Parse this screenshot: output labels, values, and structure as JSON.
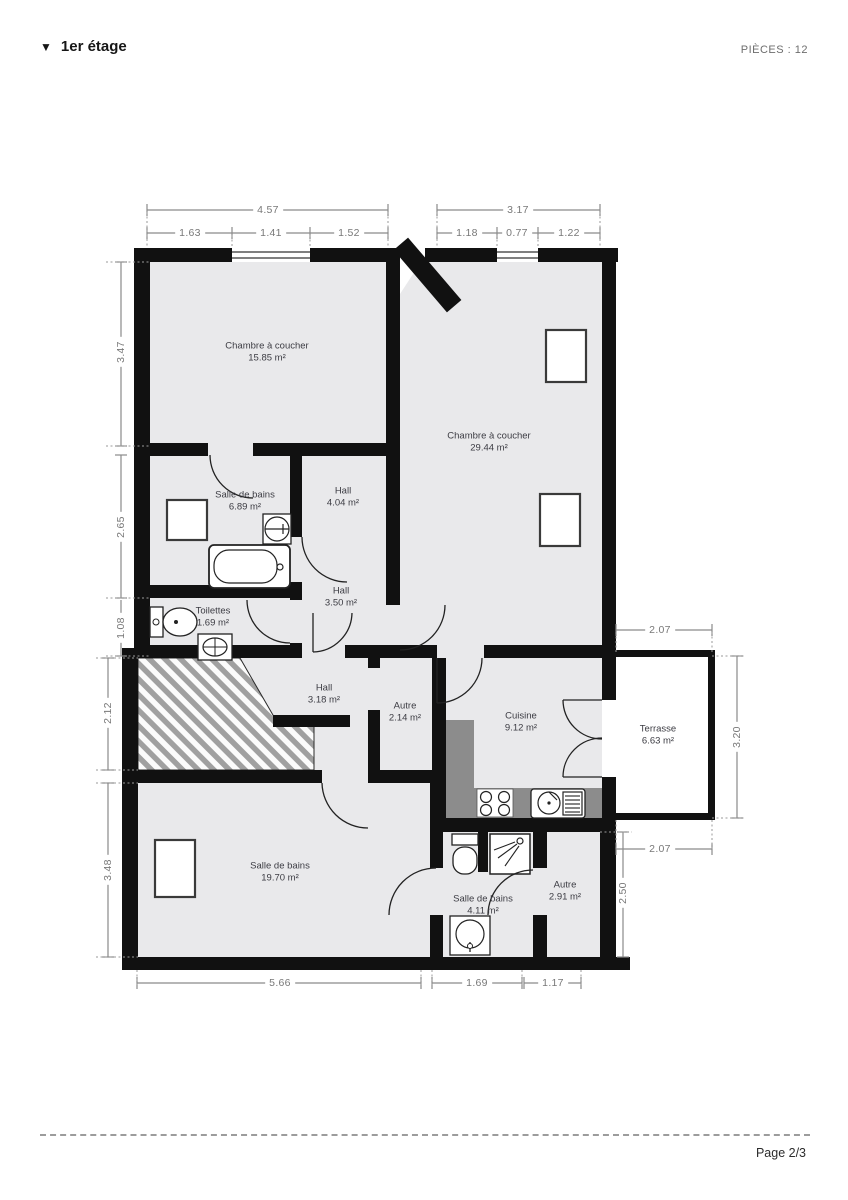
{
  "header": {
    "collapse_icon": "▼",
    "title": "1er étage",
    "pieces_label": "PIÈCES : 12"
  },
  "footer": {
    "page_label": "Page 2/3"
  },
  "rooms": [
    {
      "name": "Chambre à coucher",
      "area": "15.85 m²"
    },
    {
      "name": "Chambre à coucher",
      "area": "29.44 m²"
    },
    {
      "name": "Salle de bains",
      "area": "6.89 m²"
    },
    {
      "name": "Hall",
      "area": "4.04 m²"
    },
    {
      "name": "Hall",
      "area": "3.50 m²"
    },
    {
      "name": "Toilettes",
      "area": "1.69 m²"
    },
    {
      "name": "Hall",
      "area": "3.18 m²"
    },
    {
      "name": "Autre",
      "area": "2.14 m²"
    },
    {
      "name": "Cuisine",
      "area": "9.12 m²"
    },
    {
      "name": "Terrasse",
      "area": "6.63 m²"
    },
    {
      "name": "Salle de bains",
      "area": "19.70 m²"
    },
    {
      "name": "Salle de bains",
      "area": "4.11 m²"
    },
    {
      "name": "Autre",
      "area": "2.91 m²"
    }
  ],
  "dims": {
    "top_total": [
      "4.57",
      "3.17"
    ],
    "top_sub": [
      "1.63",
      "1.41",
      "1.52",
      "1.18",
      "0.77",
      "1.22"
    ],
    "left": [
      "3.47",
      "2.65",
      "1.08",
      "2.12",
      "3.48"
    ],
    "right": [
      "2.07",
      "3.20",
      "2.07",
      "2.50"
    ],
    "bottom": [
      "5.66",
      "1.69",
      "1.17"
    ]
  },
  "colors": {
    "wall": "#111111",
    "floor": "#e9e9eb",
    "counter": "#8c8c8c",
    "dimension": "#8a8a8a",
    "hatch_stripe": "#a0a0a0"
  }
}
